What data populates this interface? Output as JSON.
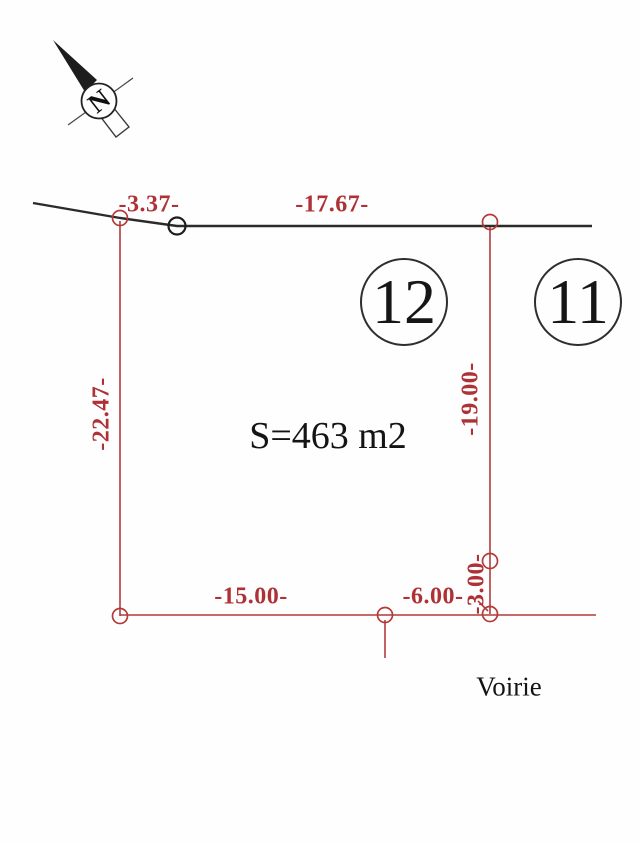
{
  "drawing": {
    "title": "parcel-survey-plan",
    "north_letter": "N",
    "area_label": "S=463 m2",
    "road_label": "Voirie",
    "parcels": {
      "left_number": "12",
      "right_number": "11"
    },
    "dimensions": {
      "top_offset": "-3.37-",
      "top_width": "-17.67-",
      "west_side": "-22.47-",
      "east_side": "-19.00-",
      "south_width": "-15.00-",
      "south_offset": "-6.00-",
      "east_small": "-3.00-"
    },
    "colors": {
      "dimension_red": "#ae3235",
      "ink_black": "#2b2b2b"
    }
  }
}
